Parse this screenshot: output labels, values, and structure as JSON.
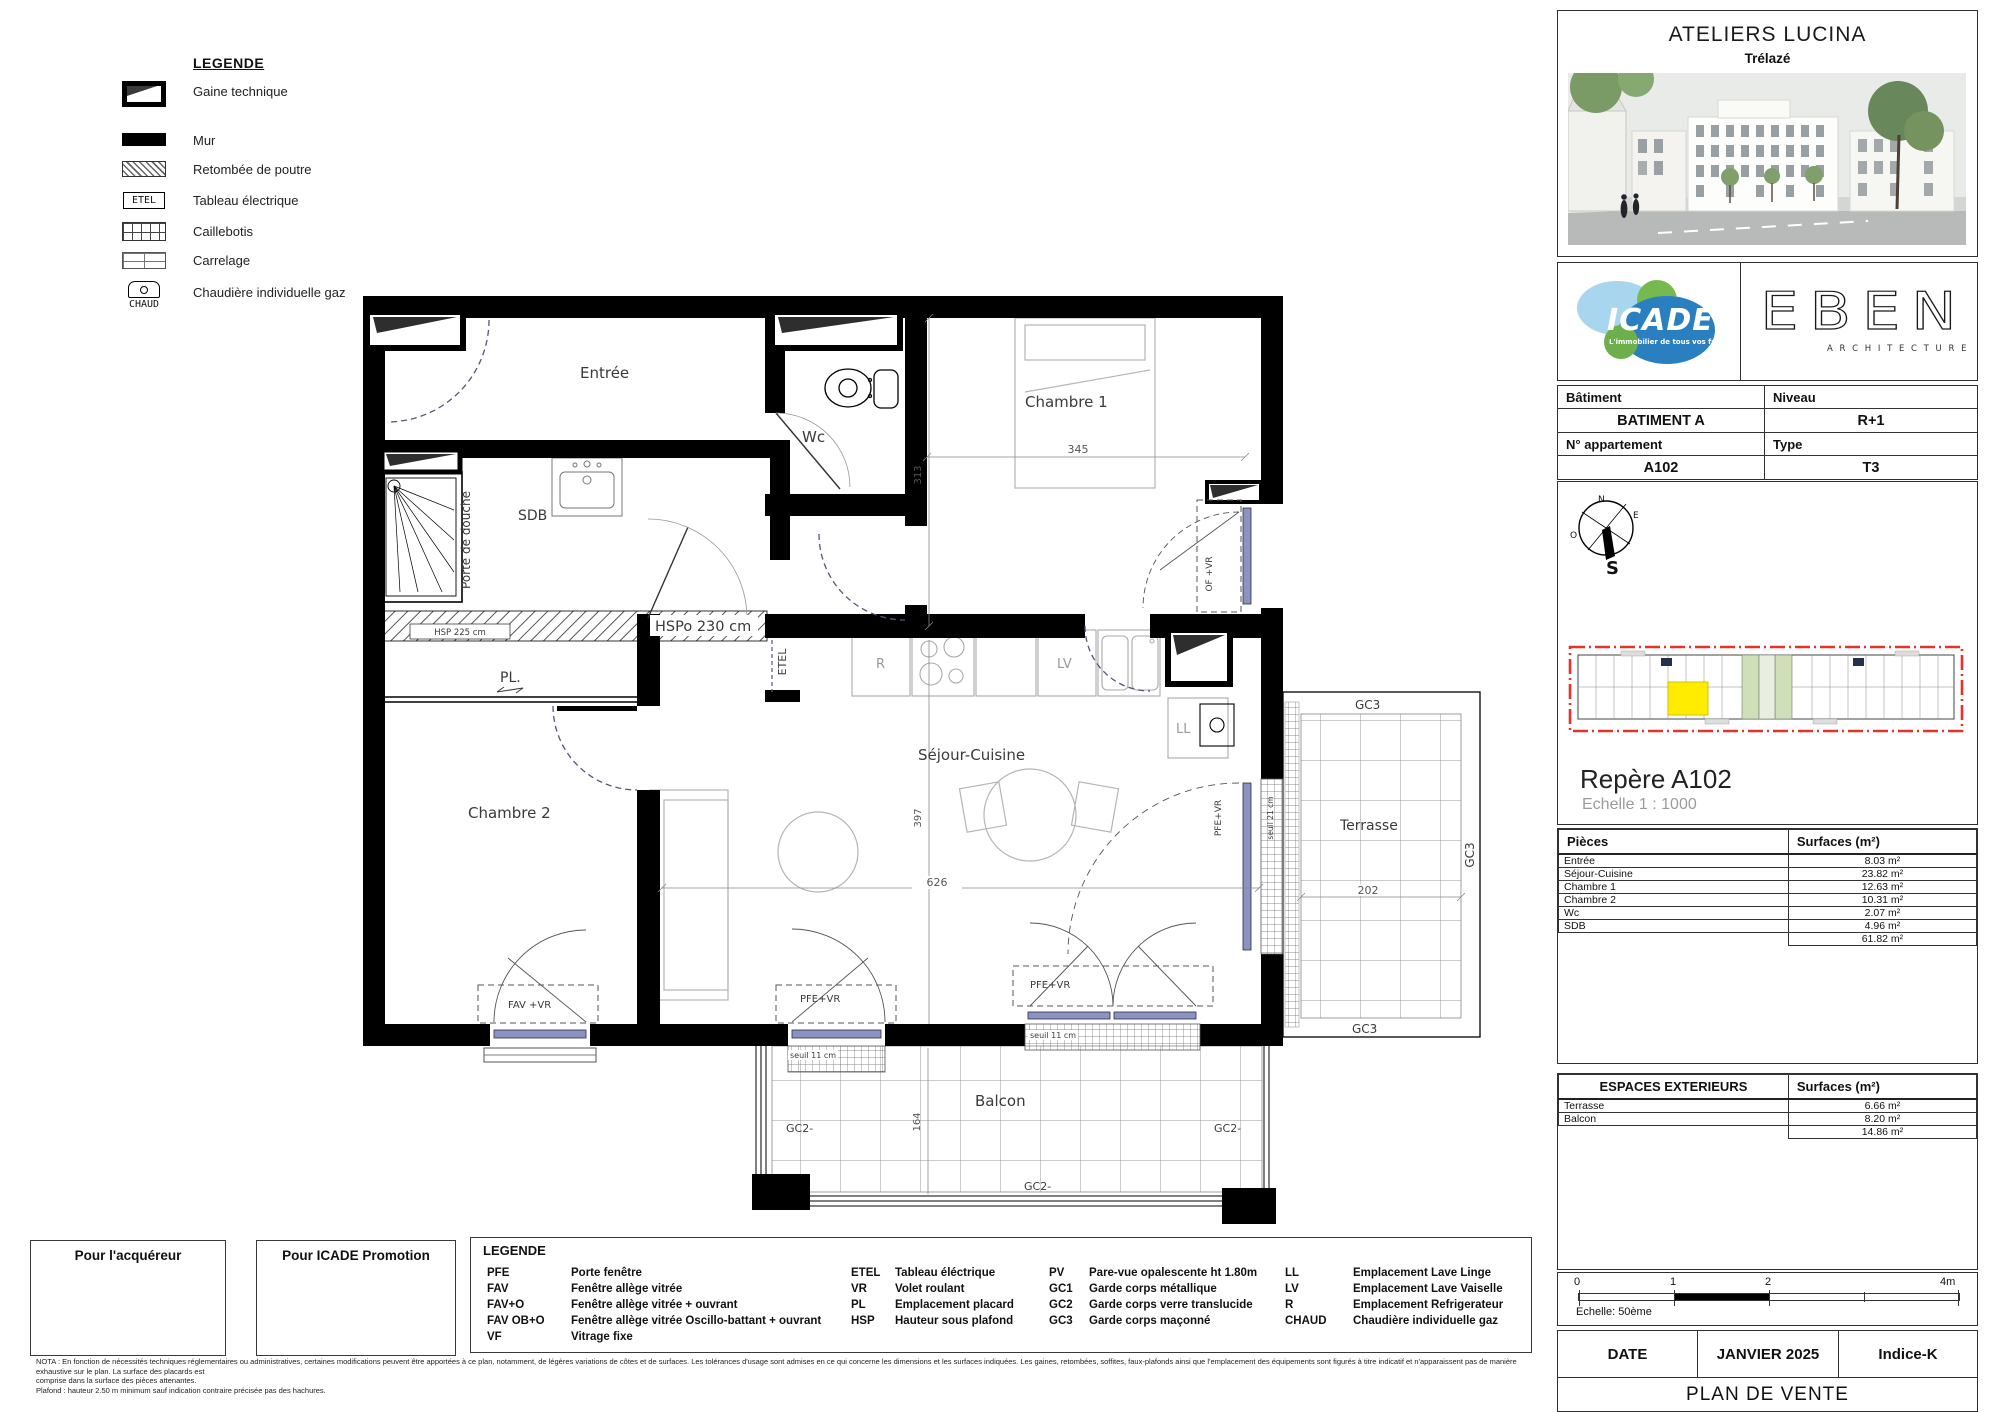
{
  "legend_top": {
    "title": "LEGENDE",
    "etel_symbol": "ETEL",
    "chaud_symbol": "CHAUD",
    "items": [
      "Gaine technique",
      "Mur",
      "Retombée de poutre",
      "Tableau électrique",
      "Caillebotis",
      "Carrelage",
      "Chaudière individuelle gaz"
    ]
  },
  "plan": {
    "rooms": {
      "entree": "Entrée",
      "wc": "Wc",
      "chambre1": "Chambre 1",
      "sdb": "SDB",
      "pl": "PL.",
      "chambre2": "Chambre 2",
      "sejour": "Séjour-Cuisine",
      "terrasse": "Terrasse",
      "balcon": "Balcon"
    },
    "ann": {
      "porte_de_douche": "Porte de douche",
      "hspo": "HSPo 230 cm",
      "hsp_beam": "HSP 225 cm",
      "etel": "ETEL",
      "r": "R",
      "lv": "LV",
      "ll": "LL",
      "fav_vr": "FAV +VR",
      "pfe_vr": "PFE+VR",
      "of_vr": "OF +VR",
      "seuil11": "seuil 11 cm",
      "seuil21": "seuil 21 cm",
      "gc2": "GC2-",
      "gc3": "GC3"
    },
    "dim": {
      "d345": "345",
      "d313": "313",
      "d397": "397",
      "d626": "626",
      "d202": "202",
      "d164": "164"
    }
  },
  "sidebar": {
    "project_title": "ATELIERS LUCINA",
    "project_city": "Trélazé",
    "logos": {
      "icade": "ICADE",
      "icade_tagline": "L'immobilier de tous vos futurs",
      "eben": "EBEN",
      "eben_sub": "A R C H I T E C T U R E"
    },
    "info": {
      "batiment_label": "Bâtiment",
      "niveau_label": "Niveau",
      "batiment": "BATIMENT A",
      "niveau": "R+1",
      "appartement_label": "N° appartement",
      "type_label": "Type",
      "appartement": "A102",
      "type": "T3"
    },
    "compass": {
      "n": "N",
      "e": "E",
      "s": "S",
      "o": "O"
    },
    "repere_title": "Repère A102",
    "repere_echelle": "Echelle  1 : 1000",
    "surfaces": {
      "col_pieces": "Pièces",
      "col_surfaces": "Surfaces (m²)",
      "rows": [
        [
          "Entrée",
          "8.03 m²"
        ],
        [
          "Séjour-Cuisine",
          "23.82 m²"
        ],
        [
          "Chambre 1",
          "12.63 m²"
        ],
        [
          "Chambre 2",
          "10.31 m²"
        ],
        [
          "Wc",
          "2.07 m²"
        ],
        [
          "SDB",
          "4.96 m²"
        ]
      ],
      "total": "61.82 m²"
    },
    "exterieurs": {
      "col_espaces": "ESPACES EXTERIEURS",
      "col_surfaces": "Surfaces (m²)",
      "rows": [
        [
          "Terrasse",
          "6.66 m²"
        ],
        [
          "Balcon",
          "8.20 m²"
        ]
      ],
      "total": "14.86 m²"
    },
    "scalebar": {
      "t0": "0",
      "t1": "1",
      "t2": "2",
      "t4": "4m",
      "label": "Echelle: 50ème"
    },
    "footer": {
      "date_label": "DATE",
      "date_value": "JANVIER 2025",
      "indice": "Indice-K",
      "doc_title": "PLAN DE VENTE"
    }
  },
  "bottom": {
    "acquereur": "Pour l'acquéreur",
    "promotion": "Pour ICADE Promotion",
    "legend_title": "LEGENDE",
    "g1": [
      [
        "PFE",
        "Porte fenêtre"
      ],
      [
        "FAV",
        "Fenêtre allège vitrée"
      ],
      [
        "FAV+O",
        "Fenêtre allège vitrée + ouvrant"
      ],
      [
        "FAV OB+O",
        "Fenêtre allège vitrée Oscillo-battant + ouvrant"
      ],
      [
        "VF",
        "Vitrage fixe"
      ]
    ],
    "g2": [
      [
        "ETEL",
        "Tableau éléctrique"
      ],
      [
        "VR",
        "Volet roulant"
      ],
      [
        "PL",
        "Emplacement placard"
      ],
      [
        "HSP",
        "Hauteur sous plafond"
      ]
    ],
    "g3": [
      [
        "PV",
        "Pare-vue opalescente ht 1.80m"
      ],
      [
        "GC1",
        "Garde corps métallique"
      ],
      [
        "GC2",
        "Garde corps verre translucide"
      ],
      [
        "GC3",
        "Garde corps maçonné"
      ]
    ],
    "g4": [
      [
        "LL",
        "Emplacement Lave Linge"
      ],
      [
        "LV",
        "Emplacement Lave Vaiselle"
      ],
      [
        "R",
        "Emplacement Refrigerateur"
      ],
      [
        "CHAUD",
        "Chaudière individuelle gaz"
      ]
    ],
    "nota": [
      "NOTA : En fonction de nécessités techniques réglementaires ou administratives, certaines modifications peuvent être apportées à ce plan, notamment, de légères variations de côtes et de surfaces. Les tolérances d'usage sont admises en ce qui concerne les dimensions et les surfaces indiquées. Les gaines, retombées, soffites, faux-plafonds ainsi que l'emplacement des équipements sont figurés à titre indicatif et n'apparaissent pas de manière exhaustive sur le plan. La surface des placards est",
      "comprise dans la surface des pièces attenantes.",
      "Plafond : hauteur 2.50 m  minimum sauf indication contraire précisée pas des hachures."
    ]
  }
}
